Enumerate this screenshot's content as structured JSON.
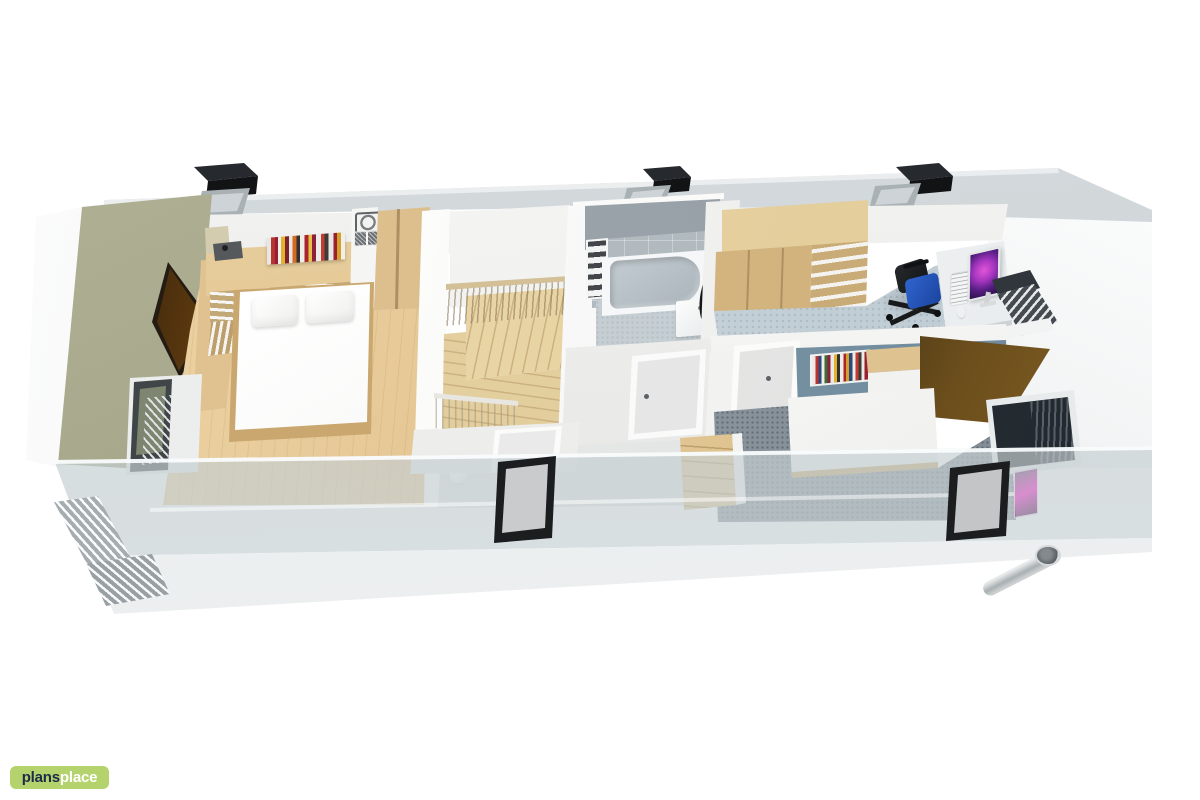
{
  "page": {
    "background": "#ffffff",
    "description": "3D cutaway floor plan render of an upper storey viewed from above at an angle, watermarked plansplace"
  },
  "logo": {
    "prefix": "plans",
    "suffix": "place"
  },
  "colors": {
    "logo_bg": "#b5d36d",
    "logo_prefix": "#1d2b4a",
    "logo_suffix": "#ffffff",
    "roof_ridge": "#c4cbce",
    "chimney": "#26292d",
    "skylight_frame": "#1b1d1f",
    "olive_wall": "#a6a68a",
    "wood_floor": "#e3c390",
    "wood_furniture": "#d8bc8a",
    "stair_wood": "#e9d5a8",
    "bathroom_wall": "#8f99a0",
    "bathroom_floor": "#ccd4d8",
    "office_carpet": "#cdd7dd",
    "chair_seat_blue": "#2f64cf",
    "monitor_glow": "#a636c0",
    "bedroom2_wall_blue": "#7691a1",
    "bedroom2_carpet": "#7f8a93",
    "bed_linen": "#ffffff",
    "glass_overlay": "rgba(205,214,217,0.72)",
    "eaves": "#f5f7f7"
  },
  "scene": {
    "rooms": [
      {
        "name": "bedroom",
        "position": "left",
        "accent_wall": "olive green",
        "floor": "light wood",
        "items": [
          "double bed",
          "two pillows",
          "headboard counter with books",
          "abstract wall art",
          "wardrobe",
          "ornate decor frame",
          "table lamp",
          "balcony door with louvres"
        ]
      },
      {
        "name": "landing-staircase",
        "position": "centre-left",
        "items": [
          "winder staircase",
          "upper railing",
          "lower railing",
          "ceiling lamp",
          "roof window"
        ]
      },
      {
        "name": "bathroom",
        "position": "centre",
        "items": [
          "bathtub",
          "washbasin",
          "oval mirror",
          "towel shelf",
          "grey tiled walls",
          "door"
        ]
      },
      {
        "name": "study",
        "position": "right-top",
        "floor": "light blue carpet",
        "items": [
          "wardrobe with open shelves",
          "desk",
          "monitor",
          "keyboard",
          "mouse",
          "office chair",
          "window with louvre blinds"
        ]
      },
      {
        "name": "bedroom-2",
        "position": "right-bottom",
        "accent_wall": "blue grey",
        "floor": "grey carpet",
        "items": [
          "bed",
          "book shelf",
          "wall cabinet",
          "horse poster",
          "window",
          "door"
        ]
      },
      {
        "name": "hallway",
        "position": "bottom-centre",
        "items": [
          "door",
          "attic steps"
        ]
      }
    ],
    "exterior": [
      "roof ridge strip",
      "3 chimney vents",
      "3 ridge skylights",
      "2 black roof windows",
      "translucent glass roof overlay",
      "white eaves",
      "louvre panels",
      "drain pipe",
      "right gable wall"
    ]
  }
}
